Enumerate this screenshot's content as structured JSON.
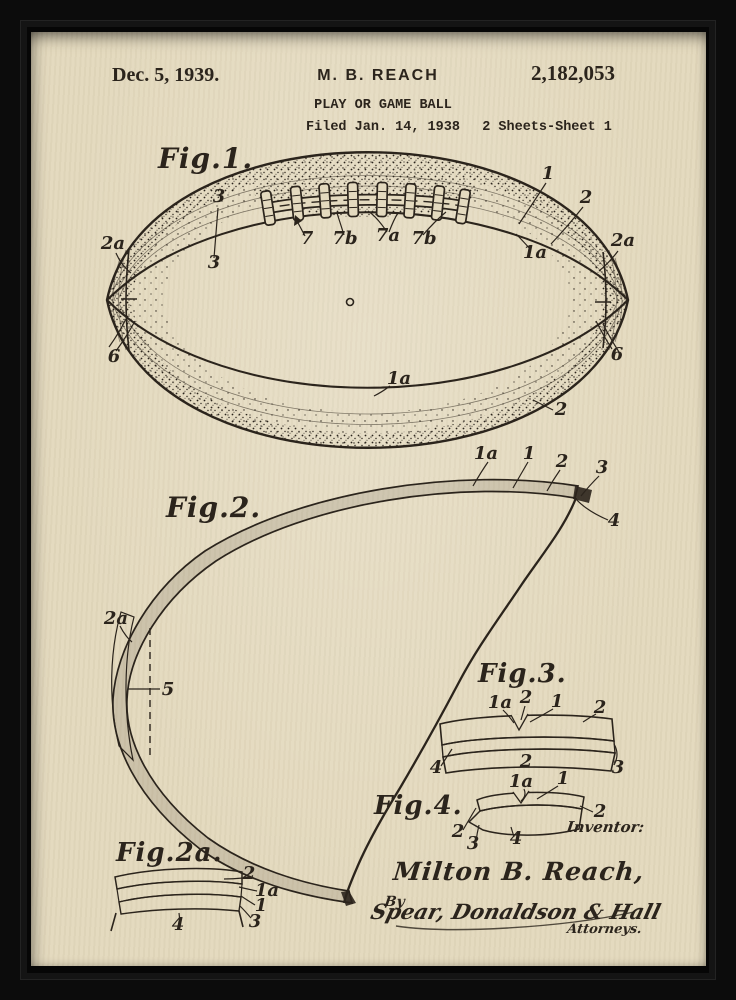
{
  "colors": {
    "frame": "#0c0c0c",
    "paper": "#e4dabf",
    "ink": "#2b241c"
  },
  "header": {
    "date": "Dec. 5, 1939.",
    "inventor_name": "M. B. REACH",
    "patent_title": "PLAY OR GAME BALL",
    "filed": "Filed Jan. 14, 1938",
    "patent_number": "2,182,053",
    "sheet_info": "2 Sheets-Sheet 1"
  },
  "figures": {
    "fig1": {
      "label": "Fig.1.",
      "callouts": {
        "c3_top": "3",
        "c3": "3",
        "c7": "7",
        "c7b_left": "7b",
        "c7a": "7a",
        "c7b_right": "7b",
        "c1": "1",
        "c2": "2",
        "c2a_right": "2a",
        "c1a_right": "1a",
        "c2a_left": "2a",
        "c6_left": "6",
        "c6_right": "6",
        "c1a_bottom": "1a",
        "c2_bottom": "2"
      }
    },
    "fig2": {
      "label": "Fig.2.",
      "callouts": {
        "c1a": "1a",
        "c1": "1",
        "c2": "2",
        "c3": "3",
        "c4": "4",
        "c2a": "2a",
        "c5": "5"
      }
    },
    "fig2a": {
      "label": "Fig.2a.",
      "callouts": {
        "c2": "2",
        "c1a": "1a",
        "c1": "1",
        "c3": "3",
        "c4": "4"
      }
    },
    "fig3": {
      "label": "Fig.3.",
      "callouts": {
        "c1a": "1a",
        "c2_top": "2",
        "c1": "1",
        "c2_right": "2",
        "c4": "4",
        "c2_mid": "2",
        "c3": "3"
      }
    },
    "fig4": {
      "label": "Fig.4.",
      "callouts": {
        "c1a": "1a",
        "c1": "1",
        "c2_right": "2",
        "c2_left": "2",
        "c3": "3",
        "c4": "4"
      }
    }
  },
  "signature": {
    "inventor_label": "Inventor:",
    "inventor_name": "Milton B. Reach,",
    "by_label": "By",
    "signature_text": "Spear, Donaldson & Hall",
    "attorneys_label": "Attorneys."
  }
}
